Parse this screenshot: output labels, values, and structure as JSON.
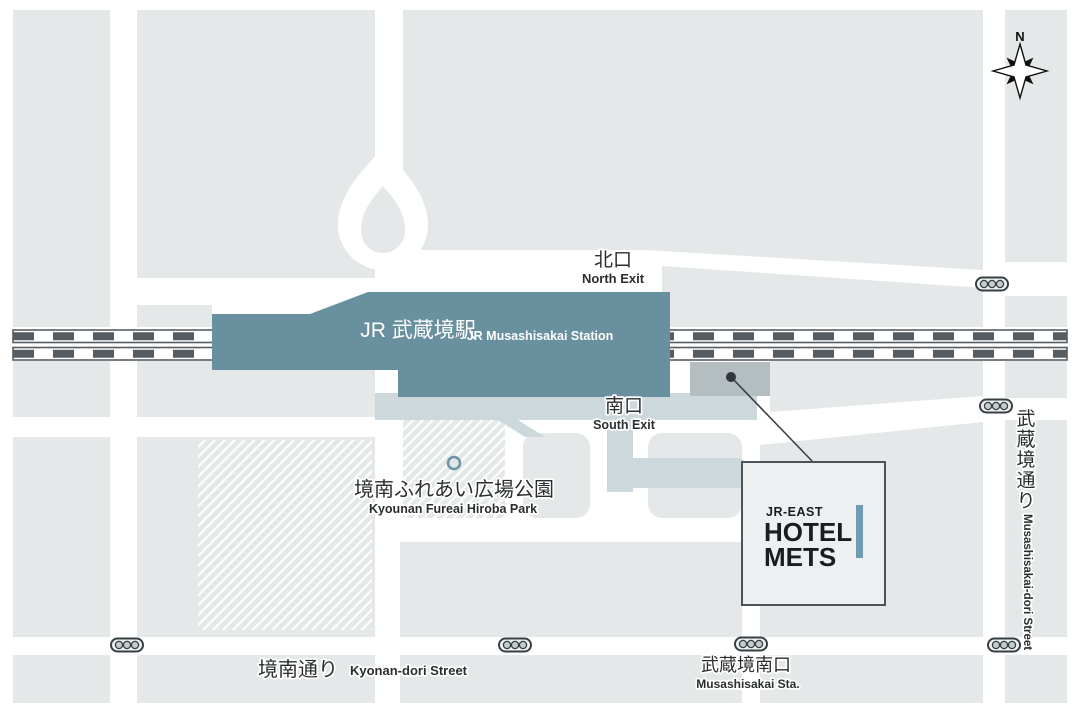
{
  "map_type": "hotel-access-map",
  "station": {
    "name_ja": "JR 武蔵境駅",
    "name_en": "JR Musashisakai Station"
  },
  "exits": {
    "north_ja": "北口",
    "north_en": "North Exit",
    "south_ja": "南口",
    "south_en": "South Exit"
  },
  "park": {
    "name_ja": "境南ふれあい広場公園",
    "name_en": "Kyounan Fureai Hiroba Park"
  },
  "hotel": {
    "brand": "JR-EAST",
    "name_line1": "HOTEL",
    "name_line2": "METS"
  },
  "streets": {
    "kyonan": {
      "ja": "境南通り",
      "en": "Kyonan-dori Street"
    },
    "musashisakai_dori": {
      "ja": "武蔵境通り",
      "en": "Musashisakai-dori Street"
    },
    "musashisakai_south_gate": {
      "ja": "武蔵境南口",
      "en": "Musashisakai Sta."
    }
  },
  "compass": {
    "north": "N"
  },
  "colors": {
    "background": "#ffffff",
    "city_block": "#e4e8e9",
    "station_building": "#69909f",
    "station_plaza": "#ccd8db",
    "hotel_building_gray": "#b4bdc0",
    "railway_dark": "#565d62",
    "label_text": "#2b2e30",
    "hotel_accent_teal": "#6f9cb2",
    "hotel_box_fill": "#edf0f1",
    "hotel_box_border": "#4d5357",
    "traffic_light_outline": "#383f43"
  }
}
